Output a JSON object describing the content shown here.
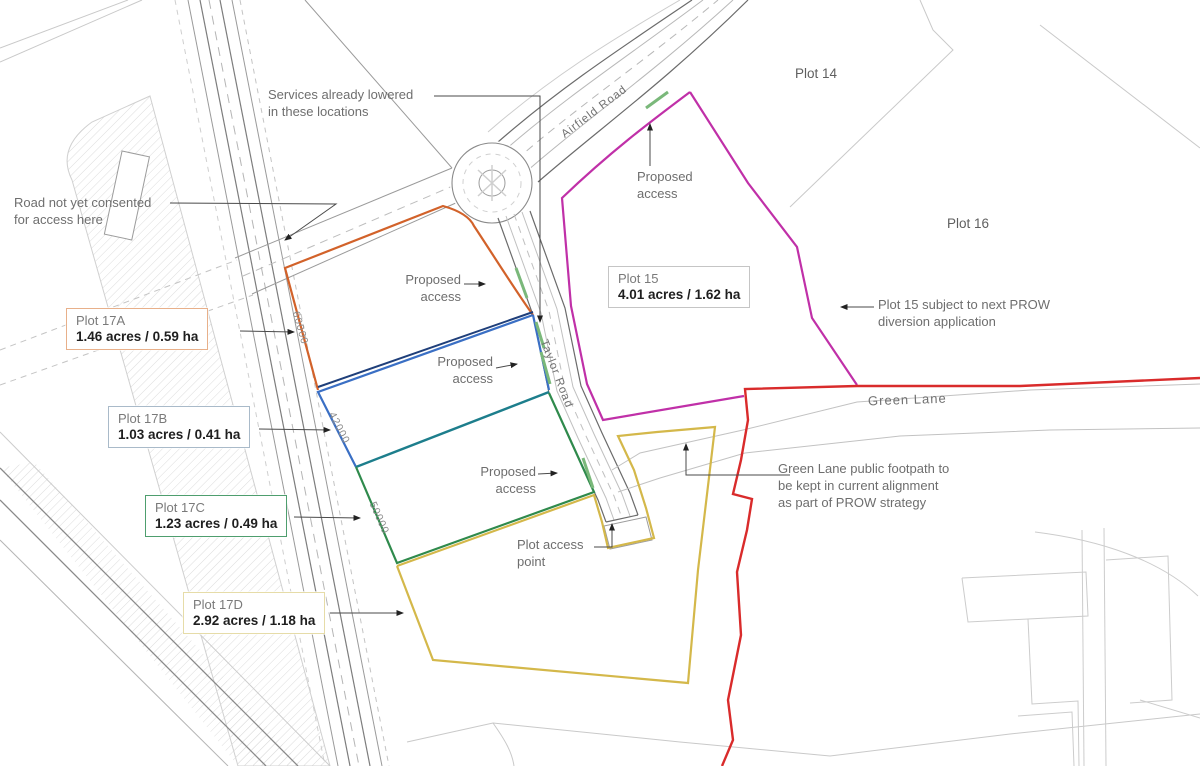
{
  "title": "Land plots site plan",
  "annotations": {
    "services_note": "Services already lowered\nin these locations",
    "road_note": "Road not yet consented\nfor access here",
    "proposed_access": "Proposed\naccess",
    "plot_access": "Plot access\npoint",
    "prow_note": "Plot 15 subject to next PROW\ndiversion application",
    "footpath_note": "Green Lane public footpath to\nbe kept in current alignment\nas part of PROW strategy"
  },
  "plots": {
    "p17a": {
      "name": "Plot 17A",
      "area": "1.46 acres / 0.59 ha",
      "color": "#d2622a"
    },
    "p17b": {
      "name": "Plot 17B",
      "area": "1.03 acres / 0.41 ha",
      "color": "#3a6fc4"
    },
    "p17c": {
      "name": "Plot 17C",
      "area": "1.23 acres / 0.49 ha",
      "color": "#2f8a4c"
    },
    "p17d": {
      "name": "Plot 17D",
      "area": "2.92 acres / 1.18 ha",
      "color": "#d4b84a"
    },
    "p15": {
      "name": "Plot 15",
      "area": "4.01 acres / 1.62 ha",
      "color": "#c030a8"
    },
    "p14": {
      "name": "Plot 14"
    },
    "p16": {
      "name": "Plot 16"
    }
  },
  "roads": {
    "airfield": "Airfield Road",
    "taylor": "Taylor Road",
    "green_lane": "Green Lane"
  },
  "dimensions": {
    "d17a": "60000",
    "d17b": "42000",
    "d17c": "50000"
  },
  "colors": {
    "site_boundary_red": "#d92b2b",
    "plot15_magenta": "#c030a8",
    "access_marker_green": "#7ab87a",
    "road_grey": "#9a9a9a",
    "hatch_grey": "#dcdcdc"
  }
}
